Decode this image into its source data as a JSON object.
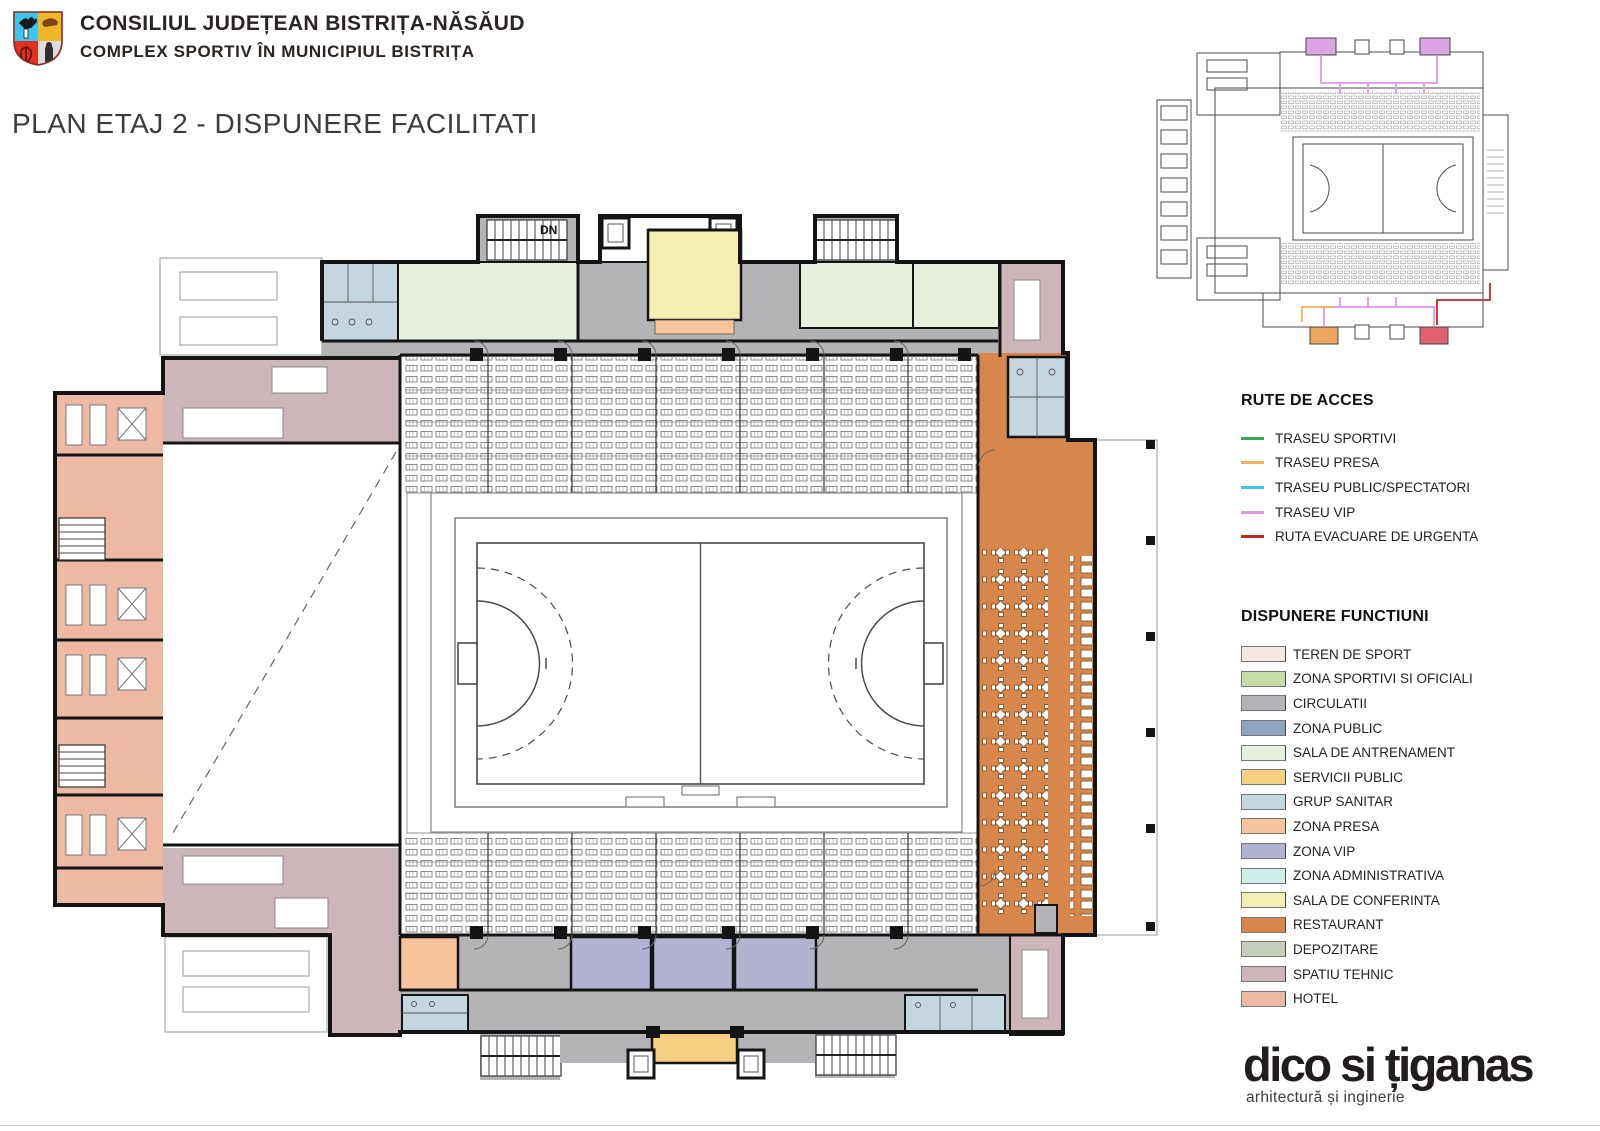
{
  "header": {
    "org": "CONSILIUL JUDEȚEAN BISTRIȚA-NĂSĂUD",
    "project": "COMPLEX SPORTIV ÎN MUNICIPIUL BISTRIȚA",
    "title": "PLAN ETAJ 2 - DISPUNERE FACILITATI"
  },
  "plan": {
    "stair_label": "DN"
  },
  "legend_routes": {
    "heading": "RUTE DE ACCES",
    "items": [
      {
        "label": "TRASEU SPORTIVI",
        "color": "#3aaa50"
      },
      {
        "label": "TRASEU PRESA",
        "color": "#f2b35c"
      },
      {
        "label": "TRASEU PUBLIC/SPECTATORI",
        "color": "#38c4ee"
      },
      {
        "label": "TRASEU VIP",
        "color": "#df9ae0"
      },
      {
        "label": "RUTA EVACUARE DE URGENTA",
        "color": "#cc2424"
      }
    ]
  },
  "legend_functions": {
    "heading": "DISPUNERE FUNCTIUNI",
    "items": [
      {
        "label": "TEREN DE SPORT",
        "color": "#f3e8e2"
      },
      {
        "label": "ZONA SPORTIVI SI OFICIALI",
        "color": "#c8dcaa"
      },
      {
        "label": "CIRCULATII",
        "color": "#b4b4b6"
      },
      {
        "label": "ZONA PUBLIC",
        "color": "#8fa3bf"
      },
      {
        "label": "SALA DE ANTRENAMENT",
        "color": "#e7efdf"
      },
      {
        "label": "SERVICII PUBLIC",
        "color": "#f7cf80"
      },
      {
        "label": "GRUP SANITAR",
        "color": "#c4d7df"
      },
      {
        "label": "ZONA PRESA",
        "color": "#f8c49b"
      },
      {
        "label": "ZONA VIP",
        "color": "#b2b3d0"
      },
      {
        "label": "ZONA ADMINISTRATIVA",
        "color": "#cfeee9"
      },
      {
        "label": "SALA DE CONFERINTA",
        "color": "#f5f0b2"
      },
      {
        "label": "RESTAURANT",
        "color": "#d8874c"
      },
      {
        "label": "DEPOZITARE",
        "color": "#c5cfbb"
      },
      {
        "label": "SPATIU TEHNIC",
        "color": "#ccb6ba"
      },
      {
        "label": "HOTEL",
        "color": "#edb9a4"
      }
    ]
  },
  "firm": {
    "name": "dico si țiganas",
    "tagline": "arhitectură și inginerie"
  }
}
